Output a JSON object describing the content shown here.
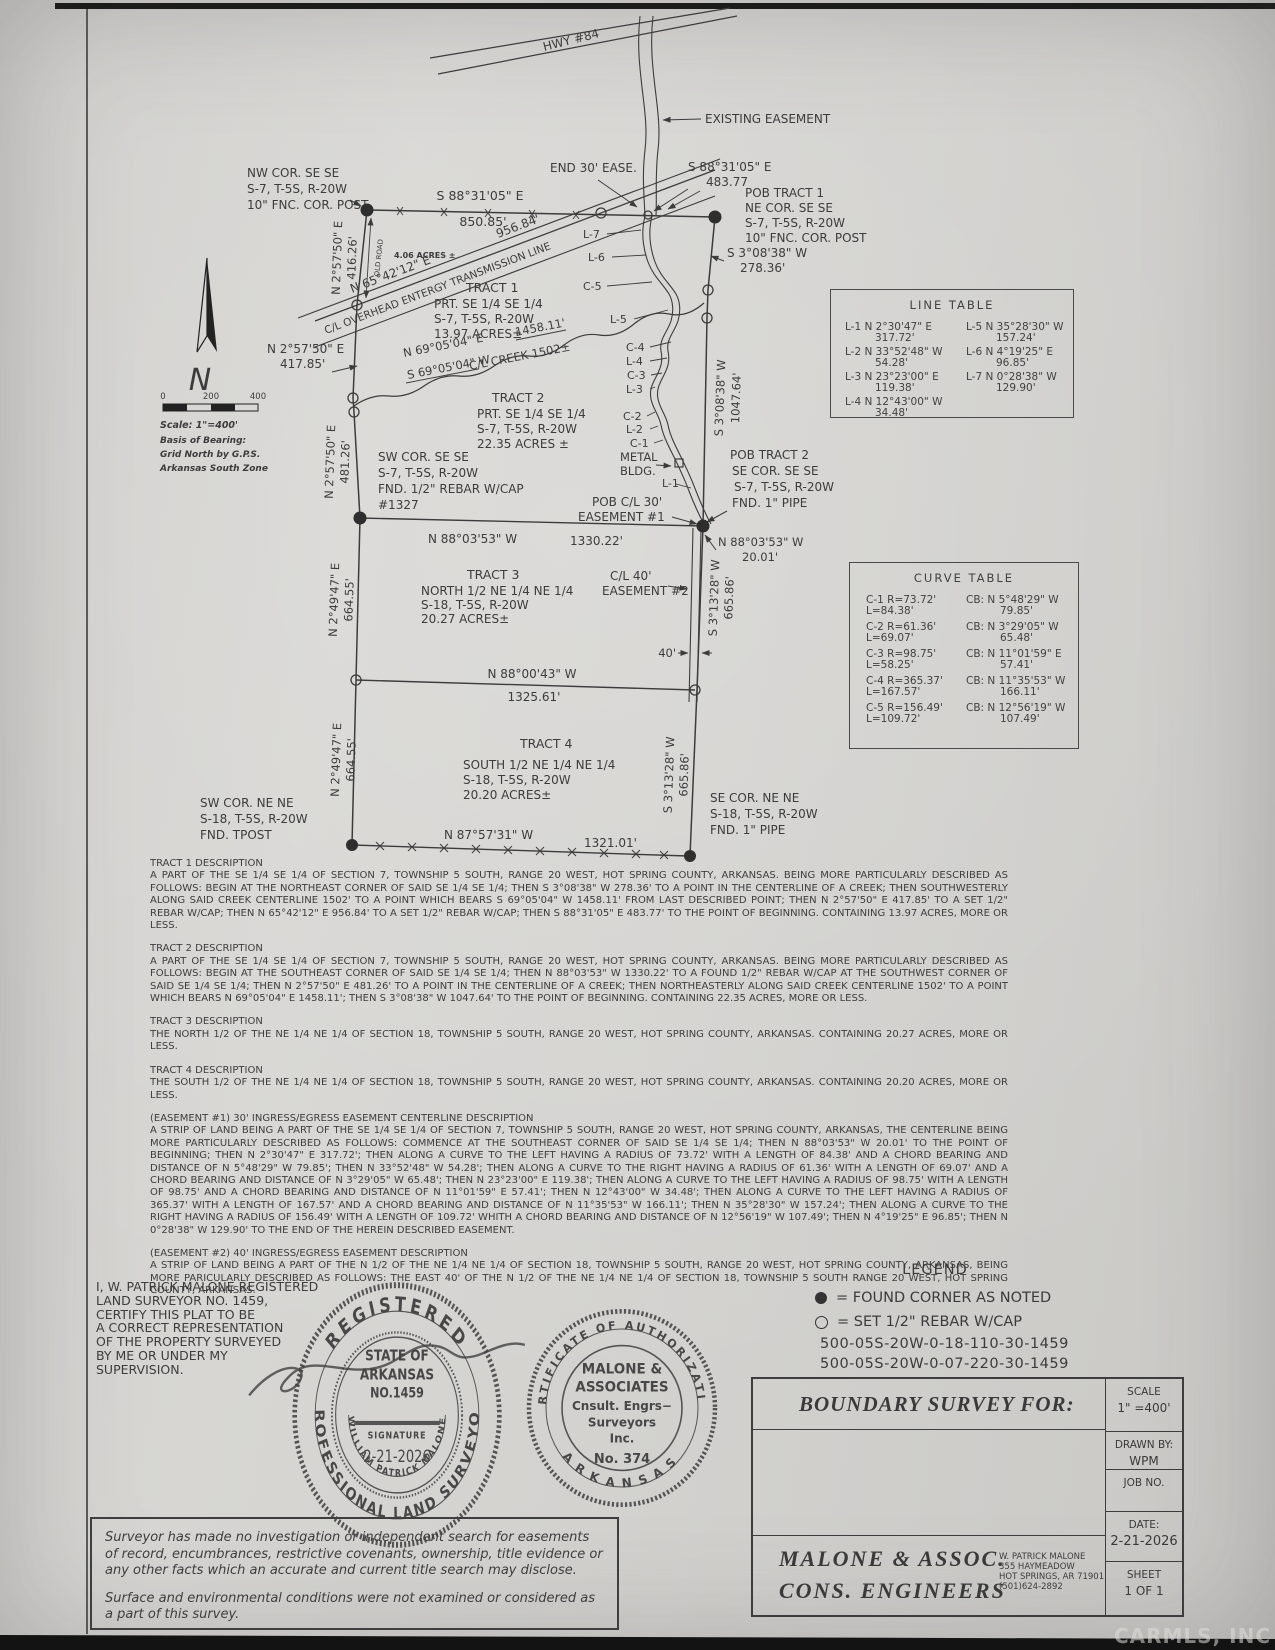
{
  "page": {
    "watermark": "CARMLS, INC"
  },
  "drawing": {
    "north": "N",
    "scale_ticks": [
      "0",
      "200",
      "400"
    ],
    "scale_note": "Scale: 1\"=400'",
    "basis": [
      "Basis of Bearing:",
      "Grid North by G.P.S.",
      "Arkansas South Zone"
    ],
    "hwy": "HWY #84",
    "existing_easement": "EXISTING EASEMENT",
    "end_ease": "END 30' EASE.",
    "seg483_bearing": "S 88°31'05\" E",
    "seg483_dist": "483.77",
    "nw_cor": [
      "NW COR. SE SE",
      "S-7, T-5S, R-20W",
      "10\" FNC. COR. POST"
    ],
    "top_bearing": "S 88°31'05\" E",
    "top_dist": "850.85'",
    "pob1": [
      "POB TRACT 1",
      "NE COR. SE SE",
      "S-7, T-5S, R-20W",
      "10\" FNC. COR. POST"
    ],
    "trans_bearing": "N 65°42'12\" E",
    "trans_dist": "956.84'",
    "trans_label": "C/L OVERHEAD ENTERGY TRANSMISSION LINE",
    "acres_406": "4.06 ACRES ±",
    "old_road": "OLD ROAD",
    "west1_bearing": "N 2°57'50\" E",
    "west1_dist": "416.26'",
    "tract1": [
      "TRACT 1",
      "PRT. SE 1/4 SE 1/4",
      "S-7, T-5S, R-20W",
      "13.97 ACRES±"
    ],
    "east1_bearing": "S 3°08'38\" W",
    "east1_dist": "278.36'",
    "creek_bearing_n": "N 69°05'04\" E",
    "creek_dist": "1458.11'",
    "creek_bearing_s": "S 69°05'04\" W",
    "creek_label": "C/L CREEK 1502±",
    "west_spur_bearing": "N 2°57'50\" E",
    "west_spur_dist": "417.85'",
    "tract2": [
      "TRACT 2",
      "PRT. SE 1/4 SE 1/4",
      "S-7, T-5S, R-20W",
      "22.35 ACRES ±"
    ],
    "west2_bearing": "N 2°57'50\" E",
    "west2_dist": "481.26'",
    "sw_sese": [
      "SW COR. SE SE",
      "S-7, T-5S, R-20W",
      "FND. 1/2\" REBAR W/CAP",
      "#1327"
    ],
    "metal_bldg": [
      "METAL",
      "BLDG."
    ],
    "pob2": [
      "POB TRACT 2",
      "SE COR. SE SE",
      "S-7, T-5S, R-20W",
      "FND. 1\" PIPE"
    ],
    "east2_bearing": "S 3°08'38\" W",
    "east2_dist": "1047.64'",
    "pob_cl30": [
      "POB C/L 30'",
      "EASEMENT #1"
    ],
    "mid1_bearing": "N 88°03'53\" W",
    "mid1_dist": "1330.22'",
    "e20_bearing": "N 88°03'53\" W",
    "e20_dist": "20.01'",
    "tract3": [
      "TRACT 3",
      "NORTH 1/2 NE 1/4 NE 1/4",
      "S-18, T-5S, R-20W",
      "20.27 ACRES±"
    ],
    "cl40": [
      "C/L 40'",
      "EASEMENT #2"
    ],
    "west3_bearing": "N 2°49'47\" E",
    "west3_dist": "664.55'",
    "east3_bearing": "S 3°13'28\" W",
    "east3_dist": "665.86'",
    "forty": "40'",
    "mid2_bearing": "N 88°00'43\" W",
    "mid2_dist": "1325.61'",
    "tract4": [
      "TRACT 4",
      "SOUTH 1/2 NE 1/4 NE 1/4",
      "S-18, T-5S, R-20W",
      "20.20 ACRES±"
    ],
    "west4_bearing": "N 2°49'47\" E",
    "west4_dist": "664.55'",
    "east4_bearing": "S 3°13'28\" W",
    "east4_dist": "665.86'",
    "sw_nene": [
      "SW COR. NE NE",
      "S-18, T-5S, R-20W",
      "FND. TPOST"
    ],
    "se_nene": [
      "SE COR. NE NE",
      "S-18, T-5S, R-20W",
      "FND. 1\" PIPE"
    ],
    "bot_bearing": "N 87°57'31\" W",
    "bot_dist": "1321.01'",
    "callouts": {
      "l1": "L-1",
      "l2": "L-2",
      "l3": "L-3",
      "l4": "L-4",
      "l5": "L-5",
      "l6": "L-6",
      "l7": "L-7",
      "c1": "C-1",
      "c2": "C-2",
      "c3": "C-3",
      "c4": "C-4",
      "c5": "C-5"
    }
  },
  "line_table": {
    "title": "LINE TABLE",
    "rows": [
      {
        "id": "L-1",
        "bearing": "N 2°30'47\" E",
        "dist": "317.72'"
      },
      {
        "id": "L-2",
        "bearing": "N 33°52'48\" W",
        "dist": "54.28'"
      },
      {
        "id": "L-3",
        "bearing": "N 23°23'00\" E",
        "dist": "119.38'"
      },
      {
        "id": "L-4",
        "bearing": "N 12°43'00\" W",
        "dist": "34.48'"
      },
      {
        "id": "L-5",
        "bearing": "N 35°28'30\" W",
        "dist": "157.24'"
      },
      {
        "id": "L-6",
        "bearing": "N 4°19'25\" E",
        "dist": "96.85'"
      },
      {
        "id": "L-7",
        "bearing": "N 0°28'38\" W",
        "dist": "129.90'"
      }
    ]
  },
  "curve_table": {
    "title": "CURVE TABLE",
    "rows": [
      {
        "id": "C-1",
        "radius": "R=73.72'",
        "length": "L=84.38'",
        "cb": "CB: N 5°48'29\" W",
        "cd": "79.85'"
      },
      {
        "id": "C-2",
        "radius": "R=61.36'",
        "length": "L=69.07'",
        "cb": "CB: N 3°29'05\" W",
        "cd": "65.48'"
      },
      {
        "id": "C-3",
        "radius": "R=98.75'",
        "length": "L=58.25'",
        "cb": "CB: N 11°01'59\" E",
        "cd": "57.41'"
      },
      {
        "id": "C-4",
        "radius": "R=365.37'",
        "length": "L=167.57'",
        "cb": "CB: N 11°35'53\" W",
        "cd": "166.11'"
      },
      {
        "id": "C-5",
        "radius": "R=156.49'",
        "length": "L=109.72'",
        "cb": "CB: N 12°56'19\" W",
        "cd": "107.49'"
      }
    ]
  },
  "descriptions": [
    {
      "title": "TRACT 1 DESCRIPTION",
      "body": "A PART OF THE SE 1/4 SE 1/4 OF SECTION 7, TOWNSHIP 5 SOUTH, RANGE 20 WEST, HOT SPRING COUNTY, ARKANSAS. BEING MORE PARTICULARLY DESCRIBED AS FOLLOWS: BEGIN AT THE NORTHEAST CORNER OF SAID SE 1/4 SE 1/4; THEN S 3°08'38\" W 278.36' TO A POINT IN THE CENTERLINE OF A CREEK; THEN SOUTHWESTERLY ALONG SAID CREEK CENTERLINE 1502' TO A POINT WHICH BEARS S 69°05'04\" W 1458.11' FROM LAST DESCRIBED POINT; THEN N 2°57'50\" E 417.85' TO A SET 1/2\" REBAR W/CAP; THEN N 65°42'12\" E 956.84' TO A SET 1/2\" REBAR W/CAP; THEN S 88°31'05\" E 483.77' TO THE POINT OF BEGINNING. CONTAINING 13.97 ACRES, MORE OR LESS."
    },
    {
      "title": "TRACT 2 DESCRIPTION",
      "body": "A PART OF THE SE 1/4 SE 1/4 OF SECTION 7, TOWNSHIP 5 SOUTH, RANGE 20 WEST, HOT SPRING COUNTY, ARKANSAS. BEING MORE PARTICULARLY DESCRIBED AS FOLLOWS: BEGIN AT THE SOUTHEAST CORNER OF SAID SE 1/4 SE 1/4; THEN N 88°03'53\" W 1330.22' TO A FOUND 1/2\" REBAR W/CAP AT THE SOUTHWEST CORNER OF SAID SE 1/4 SE 1/4; THEN N 2°57'50\" E 481.26' TO A POINT IN THE CENTERLINE OF A CREEK; THEN NORTHEASTERLY ALONG SAID CREEK CENTERLINE 1502' TO A POINT WHICH BEARS N 69°05'04\" E 1458.11'; THEN S 3°08'38\" W 1047.64' TO THE POINT OF BEGINNING. CONTAINING 22.35 ACRES, MORE OR LESS."
    },
    {
      "title": "TRACT 3 DESCRIPTION",
      "body": "THE NORTH 1/2 OF THE NE 1/4 NE 1/4 OF SECTION 18, TOWNSHIP 5 SOUTH, RANGE 20 WEST, HOT SPRING COUNTY, ARKANSAS. CONTAINING 20.27 ACRES, MORE OR LESS."
    },
    {
      "title": "TRACT 4 DESCRIPTION",
      "body": "THE SOUTH 1/2 OF THE NE 1/4 NE 1/4 OF SECTION 18, TOWNSHIP 5 SOUTH, RANGE 20 WEST, HOT SPRING COUNTY, ARKANSAS. CONTAINING 20.20 ACRES, MORE OR LESS."
    },
    {
      "title": "(EASEMENT #1) 30' INGRESS/EGRESS EASEMENT CENTERLINE DESCRIPTION",
      "body": "A STRIP OF LAND BEING A PART OF THE SE 1/4 SE 1/4 OF SECTION 7, TOWNSHIP 5 SOUTH, RANGE 20 WEST, HOT SPRING COUNTY, ARKANSAS, THE CENTERLINE BEING MORE PARTICULARLY DESCRIBED AS FOLLOWS: COMMENCE AT THE SOUTHEAST CORNER OF SAID SE 1/4 SE 1/4; THEN N 88°03'53\" W 20.01' TO THE POINT OF BEGINNING; THEN N 2°30'47\" E 317.72'; THEN ALONG A CURVE TO THE LEFT HAVING A RADIUS OF 73.72' WITH A LENGTH OF 84.38' AND A CHORD BEARING AND DISTANCE OF N 5°48'29\" W 79.85'; THEN N 33°52'48\" W 54.28'; THEN ALONG A CURVE TO THE RIGHT HAVING A RADIUS OF 61.36' WITH A LENGTH OF 69.07' AND A CHORD BEARING AND DISTANCE OF N 3°29'05\" W 65.48'; THEN N 23°23'00\" E 119.38'; THEN ALONG A CURVE TO THE LEFT HAVING A RADIUS OF 98.75' WITH A LENGTH OF 98.75' AND A CHORD BEARING AND DISTANCE OF N 11°01'59\" E 57.41'; THEN N 12°43'00\" W 34.48'; THEN ALONG A CURVE TO THE LEFT HAVING A RADIUS OF 365.37' WITH A LENGTH OF 167.57' AND A CHORD BEARING AND DISTANCE OF N 11°35'53\" W 166.11'; THEN N 35°28'30\" W 157.24'; THEN ALONG A CURVE TO THE RIGHT HAVING A RADIUS OF 156.49' WITH A LENGTH OF 109.72' WHITH A CHORD BEARING AND DISTANCE OF N 12°56'19\" W 107.49'; THEN N 4°19'25\" E 96.85'; THEN N 0°28'38\" W  129.90' TO THE END OF THE HEREIN DESCRIBED EASEMENT."
    },
    {
      "title": "(EASEMENT #2) 40' INGRESS/EGRESS EASEMENT DESCRIPTION",
      "body": "A STRIP OF LAND BEING A PART OF THE N 1/2 OF THE NE 1/4 NE 1/4 OF SECTION 18, TOWNSHIP 5 SOUTH, RANGE 20 WEST, HOT SPRING COUNTY, ARKANSAS, BEING MORE PARICULARLY DESCRIBED AS FOLLOWS: THE EAST 40' OF THE N 1/2 OF THE NE 1/4 NE 1/4 OF SECTION 18, TOWNSHIP 5 SOUTH RANGE 20 WEST, HOT SPRING COUNTY, ARKANSAS."
    }
  ],
  "certification": {
    "text": "I, W. PATRICK MALONE REGISTERED\nLAND SURVEYOR NO. 1459,\nCERTIFY THIS PLAT TO BE\nA CORRECT REPRESENTATION\nOF THE PROPERTY SURVEYED\nBY ME OR UNDER MY\nSUPERVISION."
  },
  "legend": {
    "title": "LEGEND",
    "found": "= FOUND CORNER AS NOTED",
    "set": "= SET 1/2\" REBAR W/CAP"
  },
  "parcel_ids": [
    "500-05S-20W-0-18-110-30-1459",
    "500-05S-20W-0-07-220-30-1459"
  ],
  "title_block": {
    "heading": "BOUNDARY SURVEY FOR:",
    "scale_label": "SCALE",
    "scale_value": "1\" =400'",
    "drawn_label": "DRAWN BY:",
    "drawn_value": "WPM",
    "job_label": "JOB NO.",
    "date_label": "DATE:",
    "date_value": "2-21-2026",
    "sheet_label": "SHEET",
    "sheet_value": "1 OF 1",
    "firm_line1": "MALONE & ASSOC.",
    "firm_line2": "CONS. ENGINEERS",
    "address": [
      "W. PATRICK MALONE",
      "355 HAYMEADOW",
      "HOT SPRINGS, AR 71901",
      "(501)624-2892"
    ]
  },
  "seal_surveyor": {
    "ring_top": "REGISTERED",
    "ring_bottom": "PROFESSIONAL LAND SURVEYOR",
    "inner_ring": "WILLIAM PATRICK MALONE",
    "center": [
      "STATE OF",
      "ARKANSAS",
      "NO.1459"
    ],
    "signature_label": "SIGNATURE",
    "date": "2-21-2026"
  },
  "seal_authorization": {
    "ring_top": "CERTIFICATE OF AUTHORIZATION",
    "ring_bottom": "ARKANSAS",
    "center": [
      "MALONE &",
      "ASSOCIATES",
      "Cnsult. Engrs−",
      "Surveyors",
      "Inc.",
      "No. 374"
    ]
  },
  "disclaimer": {
    "para1": "Surveyor has made no investigation or independent search for easements of record, encumbrances, restrictive covenants, ownership, title evidence or any other facts which an accurate and current title search may disclose.",
    "para2": "Surface and environmental conditions were not examined or considered as a part of this survey."
  }
}
